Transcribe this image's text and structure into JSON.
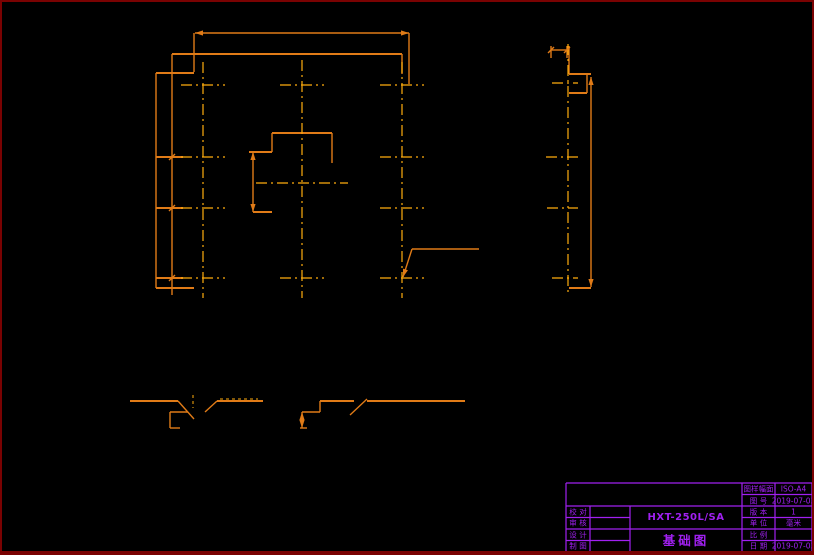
{
  "page": {
    "background": "#000000",
    "frame_color": "#7a0202"
  },
  "drawing": {
    "colors": {
      "line": "#e07b17",
      "centerline": "#ffad0d",
      "hidden": "#ffad0d",
      "titleblock": "#a020f0"
    },
    "lines": [
      [
        172,
        54,
        402,
        54,
        2
      ],
      [
        172,
        54,
        172,
        73
      ],
      [
        156,
        73,
        194,
        73,
        2
      ],
      [
        156,
        73,
        156,
        288
      ],
      [
        156,
        288,
        194,
        288,
        2
      ],
      [
        402,
        54,
        402,
        74
      ],
      [
        195,
        33,
        409,
        33
      ],
      [
        194,
        33,
        194,
        72
      ],
      [
        409,
        33,
        409,
        84
      ],
      [
        172,
        73,
        172,
        295
      ],
      [
        156,
        157,
        183,
        157,
        2
      ],
      [
        156,
        208,
        183,
        208,
        2
      ],
      [
        156,
        278,
        183,
        278,
        2
      ],
      [
        272,
        133,
        332,
        133,
        2
      ],
      [
        332,
        133,
        332,
        163
      ],
      [
        272,
        133,
        272,
        152
      ],
      [
        249,
        152,
        272,
        152,
        2
      ],
      [
        253,
        152,
        253,
        212
      ],
      [
        253,
        212,
        272,
        212,
        2
      ],
      [
        403,
        277,
        412,
        249
      ],
      [
        412,
        249,
        479,
        249
      ],
      [
        551,
        46,
        551,
        58
      ],
      [
        567,
        46,
        567,
        58
      ],
      [
        551,
        50,
        567,
        50
      ],
      [
        569,
        46,
        569,
        74
      ],
      [
        569,
        74,
        591,
        74,
        2
      ],
      [
        587,
        74,
        587,
        93
      ],
      [
        569,
        93,
        587,
        93,
        2
      ],
      [
        591,
        77,
        591,
        287
      ],
      [
        569,
        288,
        591,
        288,
        2
      ],
      [
        130,
        401,
        178,
        401,
        2
      ],
      [
        178,
        401,
        194,
        419
      ],
      [
        205,
        412,
        217,
        401
      ],
      [
        217,
        401,
        263,
        401,
        2
      ],
      [
        170,
        412,
        188,
        412
      ],
      [
        170,
        412,
        170,
        428
      ],
      [
        170,
        428,
        180,
        428
      ],
      [
        320,
        401,
        354,
        401,
        2
      ],
      [
        350,
        415,
        367,
        399
      ],
      [
        367,
        401,
        465,
        401,
        2
      ],
      [
        320,
        401,
        320,
        412
      ],
      [
        302,
        412,
        320,
        412
      ],
      [
        302,
        412,
        302,
        428
      ],
      [
        300,
        428,
        307,
        428
      ]
    ],
    "centerlines": [
      [
        203,
        62,
        203,
        298
      ],
      [
        302,
        60,
        302,
        298
      ],
      [
        402,
        62,
        402,
        298
      ],
      [
        568,
        44,
        568,
        296
      ],
      [
        181,
        85,
        225,
        85
      ],
      [
        280,
        85,
        324,
        85
      ],
      [
        380,
        85,
        424,
        85
      ],
      [
        181,
        157,
        225,
        157
      ],
      [
        380,
        157,
        424,
        157
      ],
      [
        256,
        183,
        348,
        183
      ],
      [
        181,
        208,
        225,
        208
      ],
      [
        380,
        208,
        424,
        208
      ],
      [
        181,
        278,
        225,
        278
      ],
      [
        280,
        278,
        324,
        278
      ],
      [
        380,
        278,
        424,
        278
      ],
      [
        552,
        83,
        578,
        83
      ],
      [
        546,
        157,
        578,
        157
      ],
      [
        547,
        208,
        578,
        208
      ],
      [
        552,
        278,
        578,
        278
      ]
    ],
    "hidden": [
      [
        193,
        395,
        193,
        408
      ],
      [
        220,
        399,
        258,
        399
      ]
    ],
    "arrows": [
      [
        195,
        33,
        180
      ],
      [
        409,
        33,
        0
      ],
      [
        253,
        152,
        270
      ],
      [
        253,
        212,
        90
      ],
      [
        591,
        77,
        270
      ],
      [
        591,
        287,
        90
      ],
      [
        302,
        412,
        270
      ],
      [
        302,
        428,
        90
      ],
      [
        403,
        277,
        108
      ]
    ],
    "ticks": [
      [
        551,
        50
      ],
      [
        567,
        50
      ],
      [
        172,
        157
      ],
      [
        172,
        208
      ],
      [
        172,
        278
      ]
    ],
    "titleblock_lines": [
      [
        566,
        483,
        812,
        483
      ],
      [
        812,
        483,
        812,
        552
      ],
      [
        566,
        552,
        812,
        552
      ],
      [
        566,
        483,
        566,
        552
      ],
      [
        742,
        483,
        742,
        552
      ],
      [
        775,
        483,
        775,
        552
      ],
      [
        590,
        506,
        590,
        552
      ],
      [
        630,
        506,
        630,
        552
      ],
      [
        742,
        494.5,
        812,
        494.5
      ],
      [
        566,
        506,
        812,
        506
      ],
      [
        566,
        517.5,
        630,
        517.5
      ],
      [
        742,
        517.5,
        812,
        517.5
      ],
      [
        566,
        529,
        812,
        529
      ],
      [
        566,
        540.5,
        630,
        540.5
      ],
      [
        742,
        540.5,
        812,
        540.5
      ]
    ]
  },
  "title_block": {
    "sheet_label": "图样幅面",
    "sheet_value": "ISO-A4",
    "number_label": "图 号",
    "number_value": "2019-07-03",
    "version_label": "版 本",
    "version_value": "1",
    "unit_label": "单 位",
    "unit_value": "毫米",
    "scale_label": "比 例",
    "scale_value": "",
    "date_label": "日 期",
    "date_value": "2019-07-03",
    "left_rows": [
      "校 对",
      "审 核",
      "设 计",
      "制 图"
    ],
    "model": "HXT-250L/SA",
    "drawing_title": "基础图"
  }
}
